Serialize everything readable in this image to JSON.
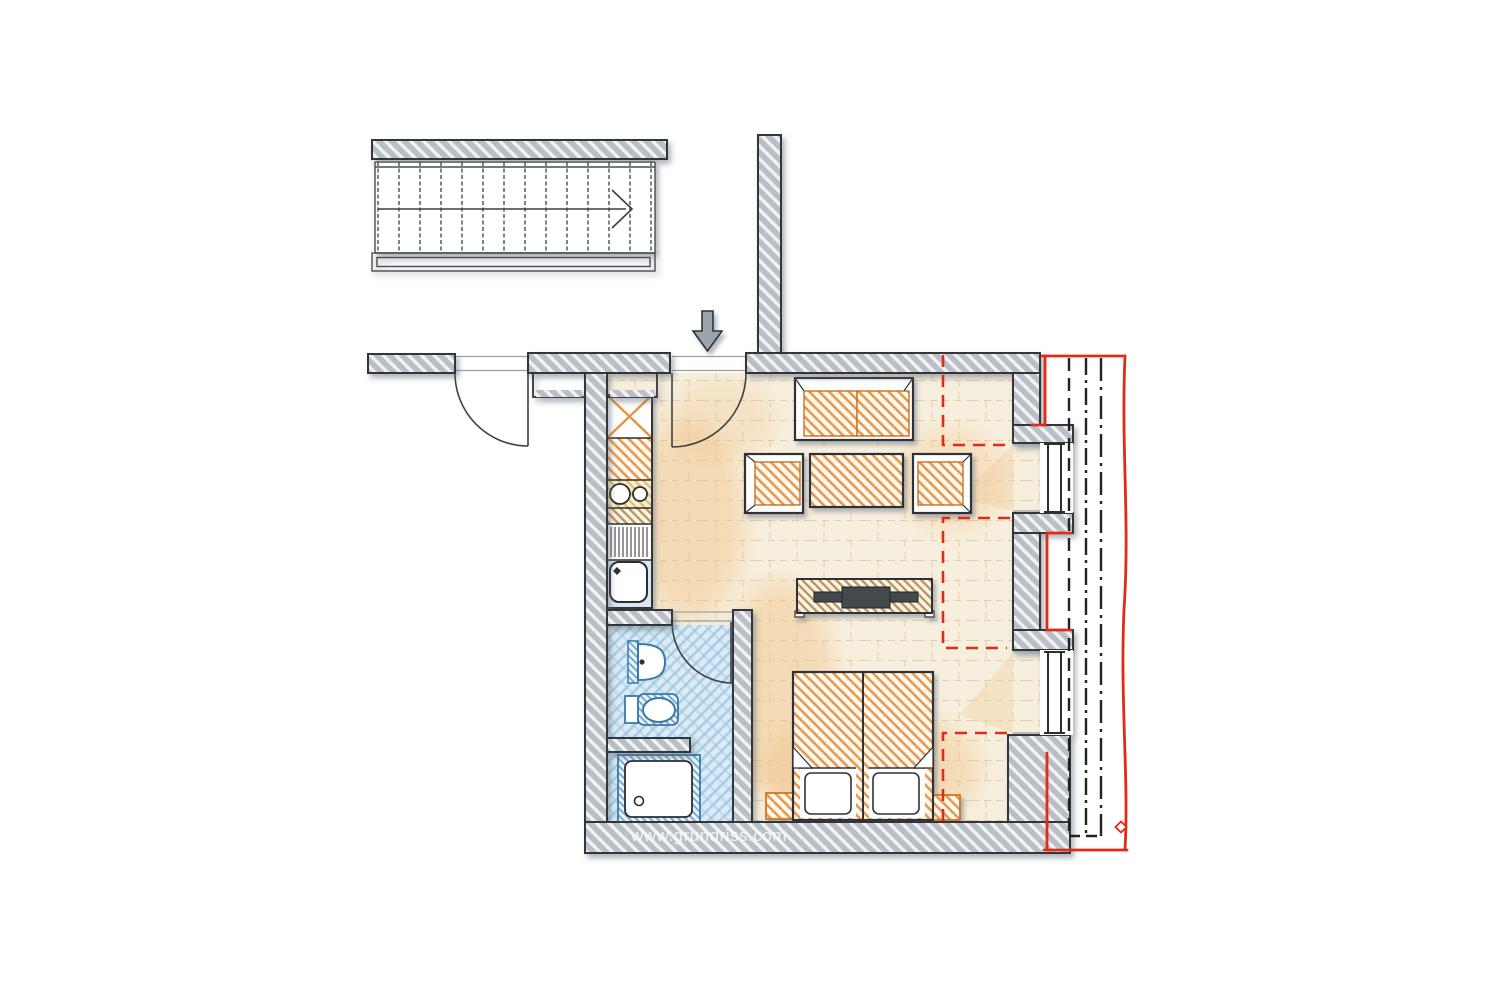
{
  "title": "Apartment floor plan",
  "watermark": {
    "text": "www.grundriss.com"
  },
  "stairs": {
    "tread_count": 14,
    "direction_icon": "stair-direction-arrow"
  },
  "icons": {
    "entrance_arrow": "down-arrow marking the apartment entrance",
    "stair_direction_arrow": "chevron showing stair walking direction"
  },
  "colors": {
    "background": "#ffffff",
    "wall_fill": "#b9bfc4",
    "wall_outline": "#33363a",
    "floor_fill": "#f7efde",
    "floor_tile_line": "#dcc9a6",
    "floor_warm_wash": "#f0c488",
    "furniture_orange": "#e99342",
    "furniture_orange_dark": "#cf7722",
    "sideboard_tan": "#b9935c",
    "tv_dark": "#45494d",
    "bath_outline_blue": "#3a79a8",
    "bath_hatch_blue": "#9ec7e2",
    "bath_floor_blue": "#dcebf5",
    "kitchen_counter_yellow": "#e3bc66",
    "roof_line_red": "#e12b19",
    "roof_dash_black": "#222222",
    "arrow_gray": "#9aa5ad",
    "stair_line": "#4a4d50"
  }
}
